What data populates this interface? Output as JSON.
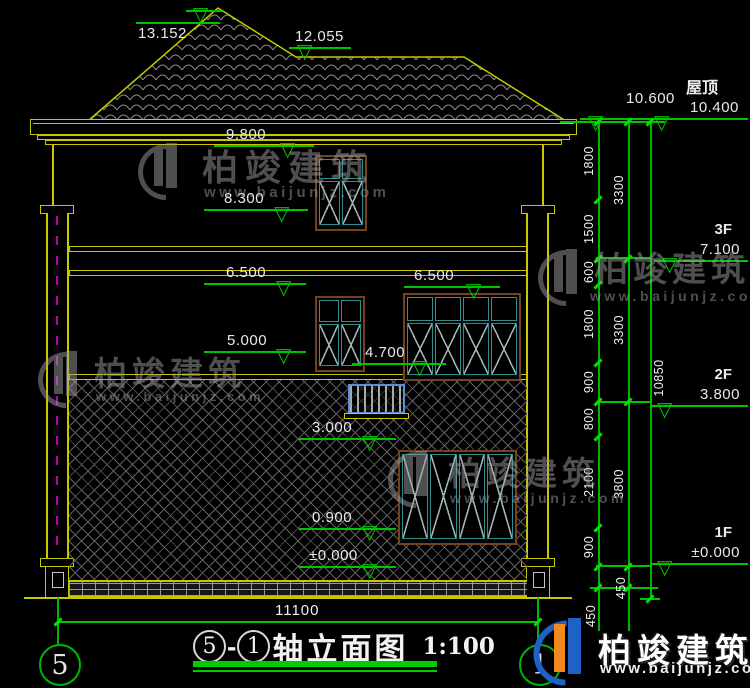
{
  "drawing": {
    "axis_title": {
      "left_axis": "5",
      "separator": "-",
      "right_axis": "1",
      "name": "轴立面图",
      "scale": "1:100"
    },
    "roof_label": "屋顶",
    "floors": {
      "f3": "3F",
      "f2": "2F",
      "f1": "1F"
    },
    "levels_left": {
      "main_ridge": "13.152",
      "secondary_ridge": "12.055",
      "eave": "9.800",
      "f3_window_top": "8.300",
      "f3_window_sill_left": "6.500",
      "f3_window_sill_right": "6.500",
      "f2_window_top": "5.000",
      "f2_window_sill": "4.700",
      "f2_railing": "3.000",
      "f1_window_sill": "0.900",
      "ground": "±0.000"
    },
    "levels_right": {
      "roof_high": "10.600",
      "roof_low": "10.400",
      "f3_floor": "7.100",
      "f2_floor": "3.800",
      "f1_floor": "±0.000"
    },
    "dimensions": {
      "total_width": "11100",
      "total_height": "10850",
      "detail_chain": [
        "1800",
        "1500",
        "600",
        "1800",
        "900",
        "800",
        "2100",
        "900",
        "450"
      ],
      "storey_chain": [
        "3300",
        "3300",
        "3800",
        "450"
      ]
    },
    "grid_bubbles": {
      "left": "5",
      "right": "1"
    }
  },
  "watermark": {
    "brand": "柏竣建筑",
    "site": "www.baijunjz.com"
  },
  "footer_logo": {
    "brand": "柏竣建筑",
    "site": "www.baijunjz.com"
  },
  "icons": {
    "level_triangle": "▽"
  }
}
